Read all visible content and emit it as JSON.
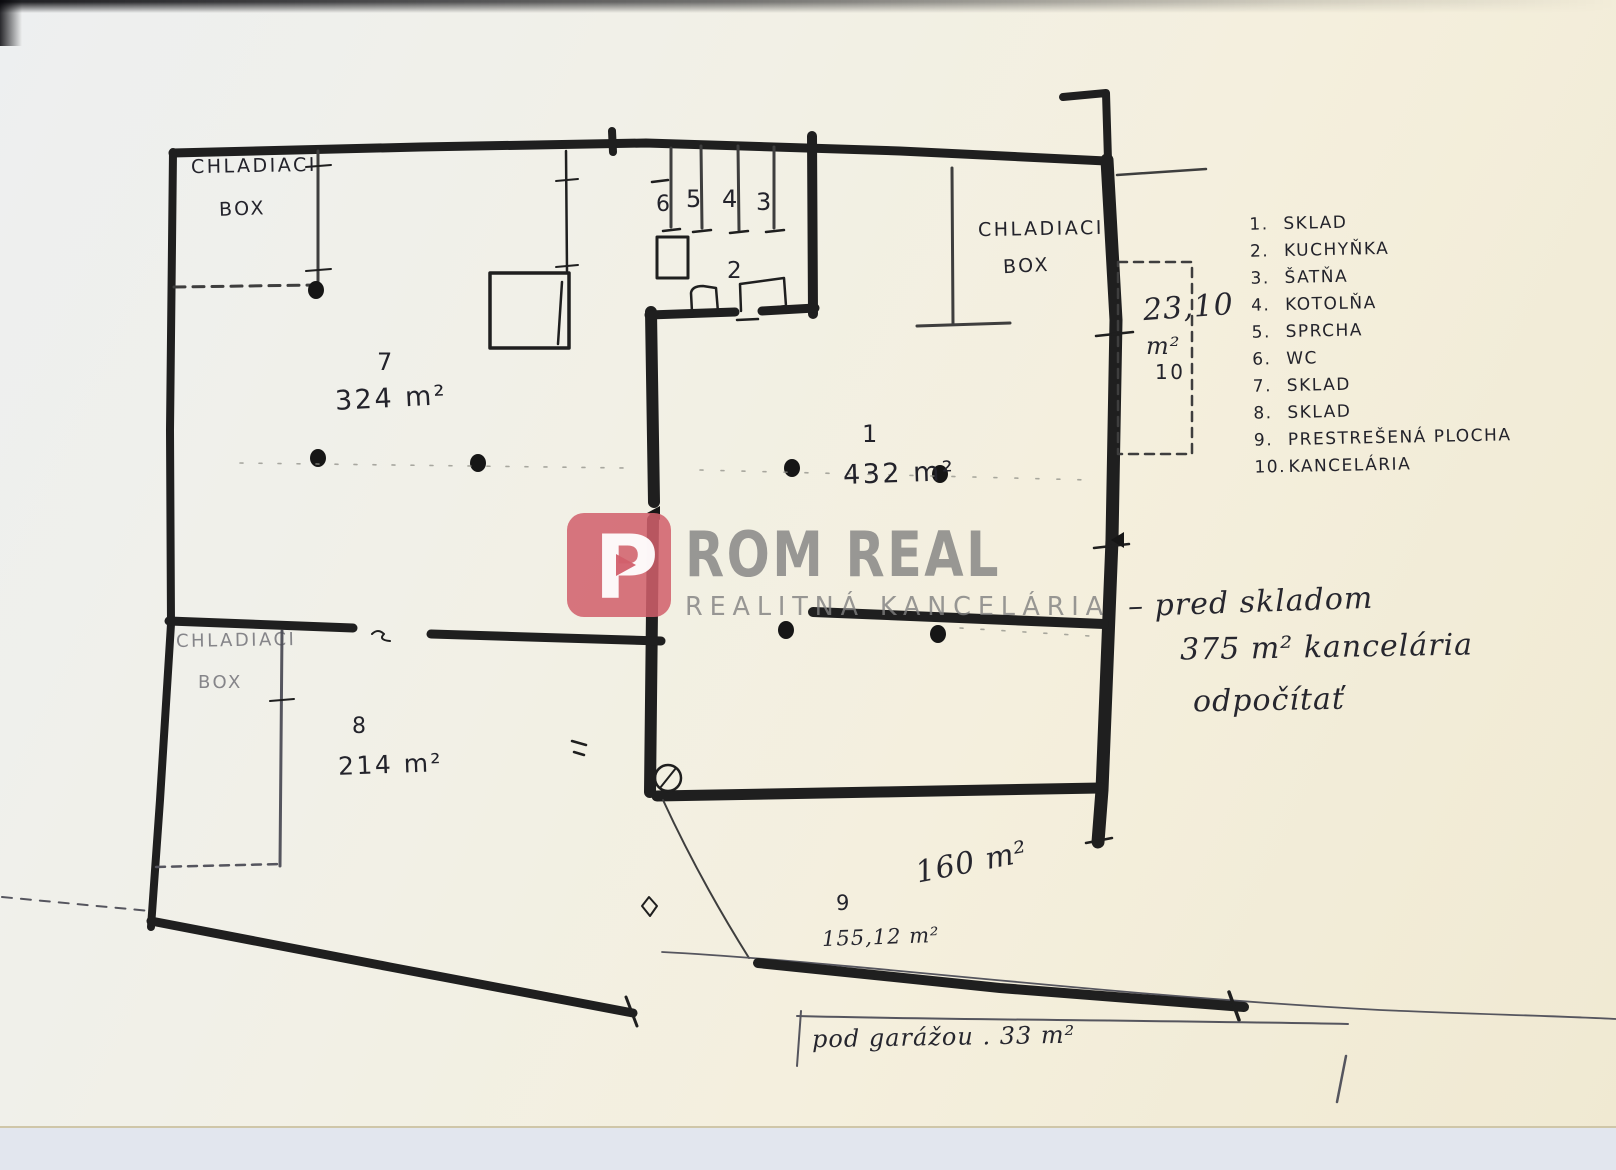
{
  "colors": {
    "ink": "#1f1f1f",
    "paper": "#f2efe2",
    "backdrop": "#e2e6ee",
    "logo_red": "#d4616d",
    "logo_gray": "#9a9a9a"
  },
  "watermark": {
    "logo_letter": "P",
    "brand": "ROM REAL",
    "subtitle": "REALITNÁ KANCELÁRIA"
  },
  "legend": {
    "items": [
      {
        "num": "1.",
        "label": "SKLAD"
      },
      {
        "num": "2.",
        "label": "KUCHYŇKA"
      },
      {
        "num": "3.",
        "label": "ŠATŇA"
      },
      {
        "num": "4.",
        "label": "KOTOLŇA"
      },
      {
        "num": "5.",
        "label": "SPRCHA"
      },
      {
        "num": "6.",
        "label": "WC"
      },
      {
        "num": "7.",
        "label": "SKLAD"
      },
      {
        "num": "8.",
        "label": "SKLAD"
      },
      {
        "num": "9.",
        "label": "PRESTREŠENÁ PLOCHA"
      },
      {
        "num": "10.",
        "label": "KANCELÁRIA"
      }
    ]
  },
  "rooms": {
    "cold_box_top_left": {
      "line1": "CHLADIACI",
      "line2": "BOX"
    },
    "cold_box_right": {
      "line1": "CHLADIACI",
      "line2": "BOX"
    },
    "cold_box_bottom_left": {
      "line1": "CHLADIACI",
      "line2": "BOX"
    },
    "room7": {
      "number": "7",
      "area": "324 m²"
    },
    "room1": {
      "number": "1",
      "area": "432 m²"
    },
    "room8": {
      "number": "8",
      "area": "214 m²"
    },
    "room2": {
      "number": "2"
    },
    "room10": {
      "area": "23,10",
      "unit": "m²",
      "number": "10"
    },
    "stall6": "6",
    "stall5": "5",
    "stall4": "4",
    "stall3": "3"
  },
  "annotations": {
    "outdoor_area": "160 m²",
    "outdoor_number": "9",
    "outdoor_area2": "155,12 m²",
    "note_line1": "– pred skladom",
    "note_line2": "375 m² kancelária",
    "note_line3": "odpočítať",
    "bottom_note": "pod garážou . 33 m²"
  }
}
